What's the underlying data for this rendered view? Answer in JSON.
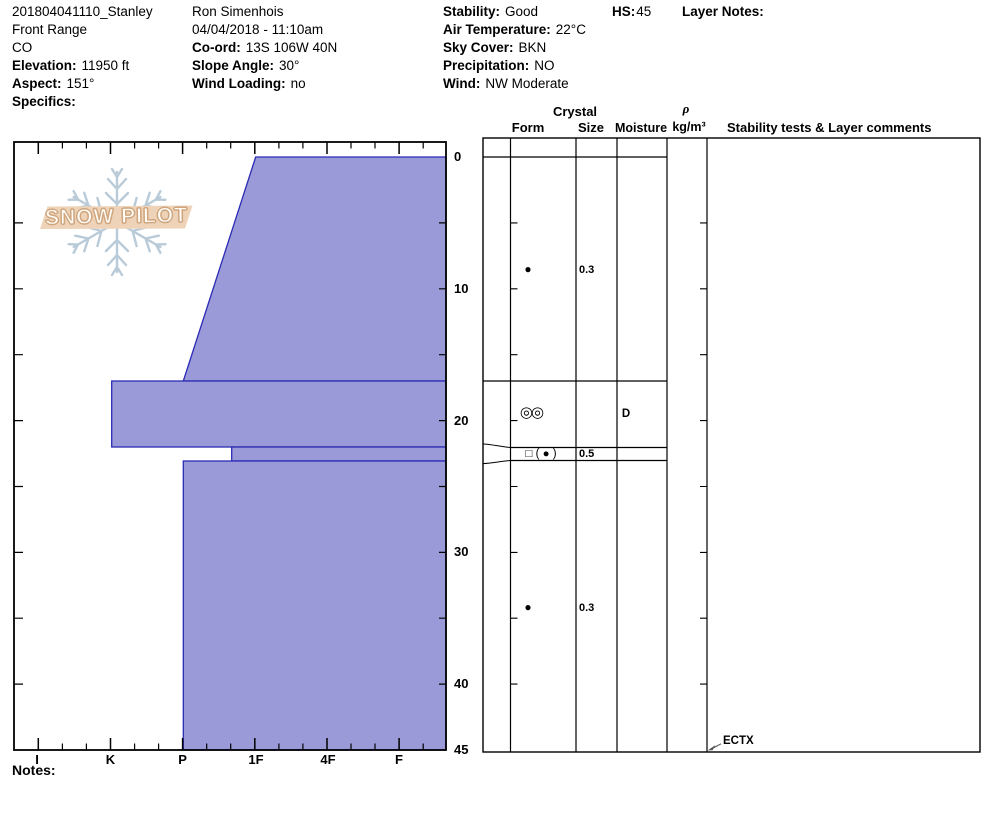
{
  "header": {
    "col1": {
      "title": "201804041110_Stanley",
      "region": "Front Range",
      "state": "CO",
      "elevation_label": "Elevation:",
      "elevation": "11950 ft",
      "aspect_label": "Aspect:",
      "aspect": "151°",
      "specifics_label": "Specifics:"
    },
    "col2": {
      "observer": "Ron Simenhois",
      "datetime": "04/04/2018 - 11:10am",
      "coord_label": "Co-ord:",
      "coord": "13S 106W 40N",
      "slope_label": "Slope Angle:",
      "slope": "30°",
      "windload_label": "Wind Loading:",
      "windload": "no"
    },
    "col3": {
      "stability_label": "Stability:",
      "stability": "Good",
      "airtemp_label": "Air Temperature:",
      "airtemp": "22°C",
      "sky_label": "Sky Cover:",
      "sky": "BKN",
      "precip_label": "Precipitation:",
      "precip": "NO",
      "wind_label": "Wind:",
      "wind": "NW Moderate"
    },
    "hs_label": "HS:",
    "hs_value": "45",
    "layer_notes_label": "Layer Notes:"
  },
  "logo": {
    "text": "SNOW PILOT"
  },
  "axes": {
    "hardness_labels": [
      "I",
      "K",
      "P",
      "1F",
      "4F",
      "F"
    ],
    "depth_labels": [
      "0",
      "10",
      "20",
      "30",
      "40",
      "45"
    ]
  },
  "table": {
    "header": {
      "crystal": "Crystal",
      "form": "Form",
      "size": "Size",
      "moisture": "Moisture",
      "rho": "ρ",
      "rho_units": "kg/m³",
      "stability": "Stability tests & Layer comments"
    },
    "rows": [
      {
        "form": "●",
        "size": "0.3",
        "moisture": ""
      },
      {
        "form": "◎◎",
        "size": "",
        "moisture": "D"
      },
      {
        "form": "□ ( ● )",
        "size": "0.5",
        "moisture": ""
      },
      {
        "form": "●",
        "size": "0.3",
        "moisture": ""
      }
    ],
    "stability_test": "ECTX"
  },
  "notes_label": "Notes:",
  "colors": {
    "layer_fill": "#9a9ad8",
    "layer_stroke": "#2b2bb4",
    "logo_banner": "#eed3b8",
    "logo_snowflake": "#b9cbd8"
  },
  "chart_data": {
    "type": "area",
    "title": "Snow pit hardness profile 201804041110_Stanley",
    "xlabel": "Hand hardness (hard → soft)",
    "x_categories": [
      "I",
      "K",
      "P",
      "1F",
      "4F",
      "F"
    ],
    "ylabel": "Depth from surface (cm)",
    "ylim": [
      0,
      45
    ],
    "y_ticks": [
      0,
      10,
      20,
      30,
      40,
      45
    ],
    "hs_cm": 45,
    "layers": [
      {
        "top_cm": 0,
        "bottom_cm": 17,
        "hardness": "1F at top grading to P at bottom",
        "grain_form": "●",
        "grain_size_mm": 0.3,
        "moisture": ""
      },
      {
        "top_cm": 17,
        "bottom_cm": 22,
        "hardness": "K",
        "grain_form": "◎◎",
        "grain_size_mm": null,
        "moisture": "D"
      },
      {
        "top_cm": 22,
        "bottom_cm": 23,
        "hardness": "1F+",
        "grain_form": "□ ( ● )",
        "grain_size_mm": 0.5,
        "moisture": ""
      },
      {
        "top_cm": 23,
        "bottom_cm": 45,
        "hardness": "P",
        "grain_form": "●",
        "grain_size_mm": 0.3,
        "moisture": ""
      }
    ],
    "stability_tests": [
      {
        "result": "ECTX",
        "depth_cm": 45
      }
    ],
    "legend_position": "none",
    "grid": false
  }
}
